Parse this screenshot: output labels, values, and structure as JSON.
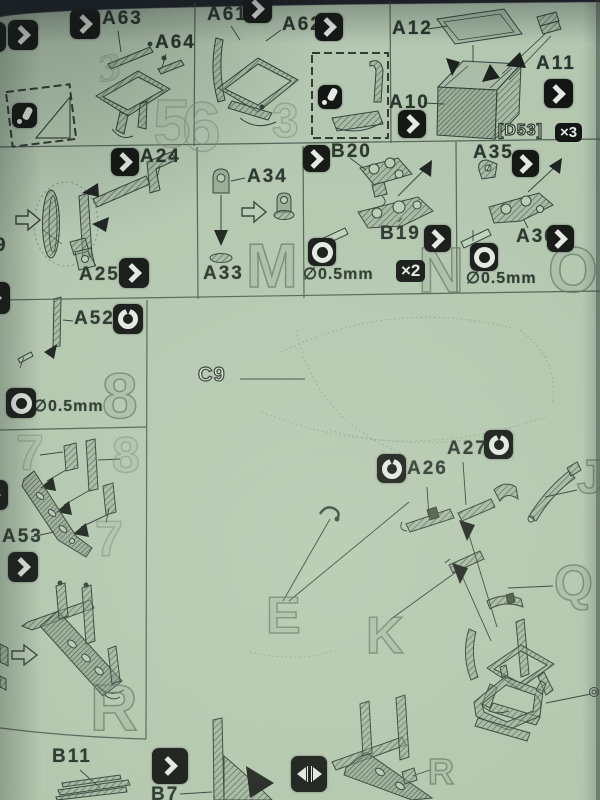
{
  "panels": {
    "step56": {
      "a63": "A63",
      "a64": "A64",
      "a61": "A61",
      "a62": "A62",
      "ghost_5": "5",
      "ghost_6": "6",
      "ghost_3": "3",
      "ghost_script3": "3"
    },
    "box": {
      "a12": "A12",
      "a10": "A10",
      "a11": "A11",
      "ref": "[D53]",
      "qty": "×3"
    },
    "lamp": {
      "a24": "A24",
      "a25": "A25"
    },
    "m": {
      "a34": "A34",
      "a33": "A33",
      "ghost": "M"
    },
    "n": {
      "b20": "B20",
      "b19": "B19",
      "drill": "∅0.5mm",
      "qty": "×2",
      "ghost": "N"
    },
    "o": {
      "a35": "A35",
      "a36": "A36",
      "drill": "∅0.5mm",
      "ghost": "O"
    },
    "eight": {
      "a52": "A52",
      "drill": "∅0.5mm",
      "ghost": "8"
    },
    "rack": {
      "a53": "A53",
      "ghost_7a": "7",
      "ghost_8": "8",
      "ghost_7b": "7"
    },
    "r": {
      "ghost": "R"
    },
    "main": {
      "c9": "C9",
      "a26": "A26",
      "a27": "A27",
      "ghost_e": "E",
      "ghost_k": "K",
      "ghost_j": "J",
      "ghost_q": "Q"
    },
    "bottom": {
      "b11": "B11",
      "b7": "B7",
      "ghost_r": "R"
    },
    "edge": {
      "n9": "9"
    }
  },
  "colors": {
    "paper": "#b9cdb5",
    "ink": "#2f3c34",
    "badge": "#0b0d0b"
  }
}
